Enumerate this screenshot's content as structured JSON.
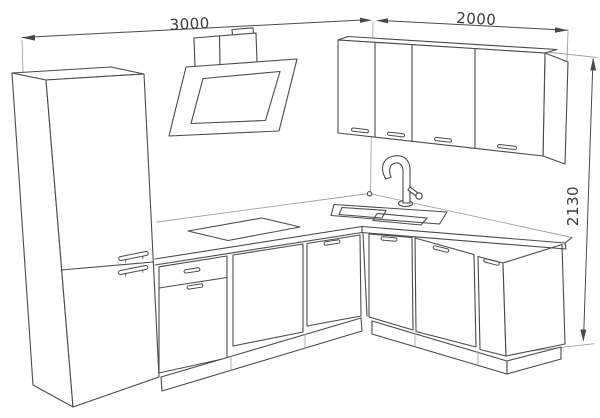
{
  "drawing": {
    "dimensions": {
      "left_run_width": {
        "label": "3000"
      },
      "right_run_width": {
        "label": "2000"
      },
      "total_height": {
        "label": "2130"
      }
    },
    "colors": {
      "background": "#ffffff",
      "line_main": "#4a4a4a",
      "line_light": "#a2a2a2",
      "dimension_text": "#3a3a3a"
    },
    "elements": [
      "tall-fridge-cabinet",
      "angled-cooker-hood",
      "wall-cabinet-four-doors",
      "double-bowl-sink",
      "mixer-tap",
      "cooktop",
      "base-cabinet-drawer-door",
      "dishwasher-front-panel",
      "corner-base-cabinet",
      "base-cabinets-right-run",
      "l-shaped-countertop",
      "plinth"
    ]
  }
}
